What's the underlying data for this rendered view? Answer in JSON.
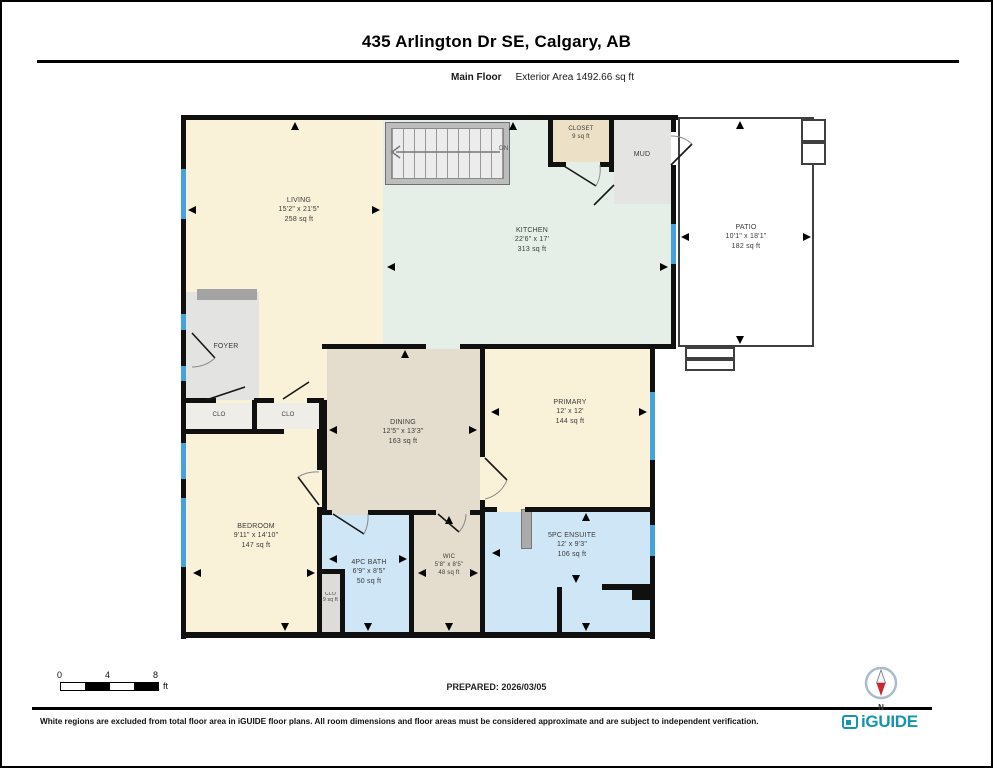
{
  "header": {
    "title": "435 Arlington Dr SE, Calgary, AB",
    "floor_label": "Main Floor",
    "area_label": "Exterior Area 1492.66 sq ft"
  },
  "rooms": [
    {
      "name": "LIVING",
      "dims": "15'2\" x 21'5\"",
      "area": "258 sq ft"
    },
    {
      "name": "KITCHEN",
      "dims": "22'6\" x 17'",
      "area": "313 sq ft"
    },
    {
      "name": "CLOSET",
      "area": "9 sq ft"
    },
    {
      "name": "MUD"
    },
    {
      "name": "PATIO",
      "dims": "10'1\" x 18'1\"",
      "area": "182 sq ft"
    },
    {
      "name": "FOYER"
    },
    {
      "name": "CLO"
    },
    {
      "name": "CLO"
    },
    {
      "name": "DINING",
      "dims": "12'5\" x 13'3\"",
      "area": "163 sq ft"
    },
    {
      "name": "PRIMARY",
      "dims": "12' x 12'",
      "area": "144 sq ft"
    },
    {
      "name": "BEDROOM",
      "dims": "9'11\" x 14'10\"",
      "area": "147 sq ft"
    },
    {
      "name": "4PC BATH",
      "dims": "6'9\" x 8'5\"",
      "area": "50 sq ft"
    },
    {
      "name": "CLO",
      "area": "9 sq ft"
    },
    {
      "name": "WIC",
      "dims": "5'8\" x 8'5\"",
      "area": "48 sq ft"
    },
    {
      "name": "5PC ENSUITE",
      "dims": "12' x 9'3\"",
      "area": "106 sq ft"
    }
  ],
  "stairs": {
    "label": "DN"
  },
  "scale_bar": {
    "ticks": [
      "0",
      "4",
      "8"
    ],
    "unit": "ft"
  },
  "footer": {
    "prepared": "PREPARED: 2026/03/05",
    "disclaimer": "White regions are excluded from total floor area in iGUIDE floor plans. All room dimensions and floor areas must be considered approximate and are subject to independent verification.",
    "brand": "iGUIDE",
    "compass": "N"
  },
  "colors": {
    "floor_cream": "#faf1d9",
    "kitchen_green": "#e6efe7",
    "dining_beige": "#e4dccc",
    "bath_blue": "#cfe6f7",
    "room_gray": "#e4e4e2",
    "closet_tan": "#ece1c6",
    "window_blue": "#46a2db",
    "wall_black": "#101010",
    "brand_teal": "#1794b0",
    "compass_red": "#ce2531"
  }
}
